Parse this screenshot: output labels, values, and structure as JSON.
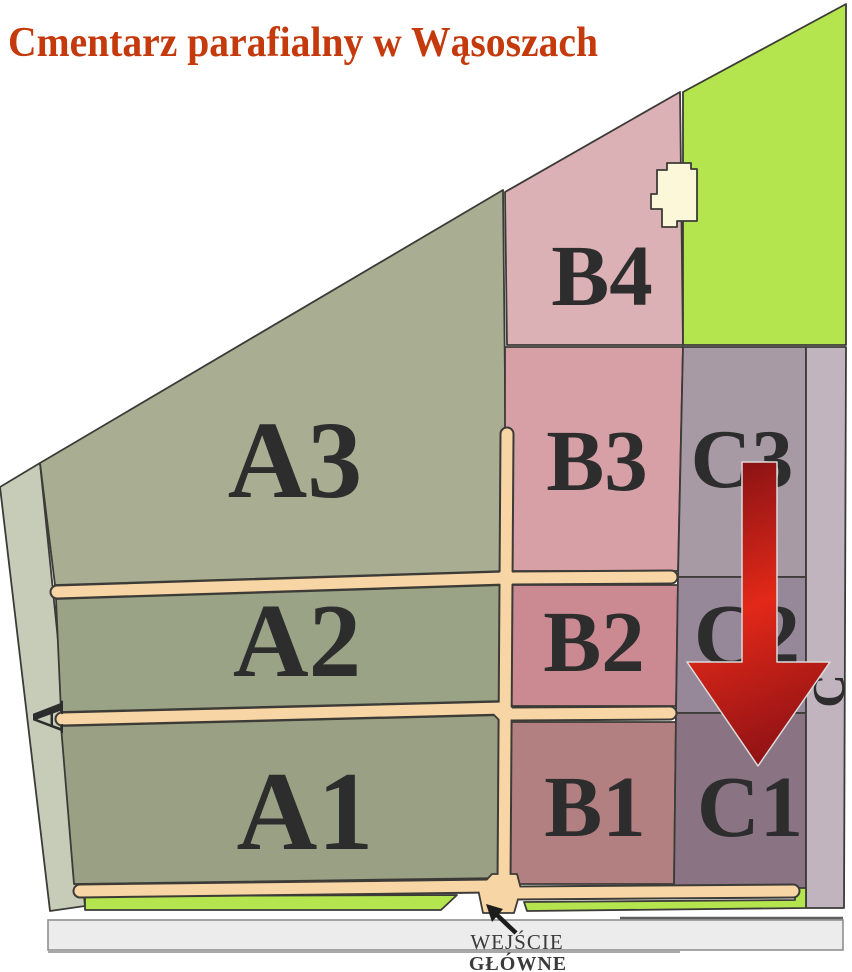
{
  "header": {
    "title": "Cmentarz parafialny w Wąsoszach",
    "color": "#c53a0c"
  },
  "map": {
    "outline": "#3c3b37",
    "label_color": "#2d2d2d",
    "path_color": "#f8d5a4",
    "green": "#b4e44e",
    "building": "#fcf7d8",
    "sections": [
      {
        "id": "A3",
        "label": "A3",
        "color": "#a9ae93"
      },
      {
        "id": "A2",
        "label": "A2",
        "color": "#9ba386"
      },
      {
        "id": "A1",
        "label": "A1",
        "color": "#99a083"
      },
      {
        "id": "B4",
        "label": "B4",
        "color": "#dcb1b6"
      },
      {
        "id": "B3",
        "label": "B3",
        "color": "#d7a0a7"
      },
      {
        "id": "B2",
        "label": "B2",
        "color": "#cb8a92"
      },
      {
        "id": "B1",
        "label": "B1",
        "color": "#b38082"
      },
      {
        "id": "C3",
        "label": "C3",
        "color": "#a79aa4"
      },
      {
        "id": "C2",
        "label": "C2",
        "color": "#968799"
      },
      {
        "id": "C1",
        "label": "C1",
        "color": "#8a7383"
      }
    ],
    "edge_strips": [
      {
        "id": "A",
        "label": "A",
        "color": "#c7ccb8"
      },
      {
        "id": "C",
        "label": "C",
        "color": "#c1b4bf"
      }
    ],
    "arrow": {
      "dark": "#7f1014",
      "bright": "#e22818",
      "dark2": "#8c1115",
      "outline": "#dcdcdc"
    },
    "road": {
      "fill": "#ececec",
      "border": "#8f8f8f"
    },
    "entrance": {
      "line1": "WEJŚCIE",
      "line2": "GŁÓWNE",
      "text_color": "#3a3a3a",
      "arrow_color": "#1c1c1c"
    }
  }
}
